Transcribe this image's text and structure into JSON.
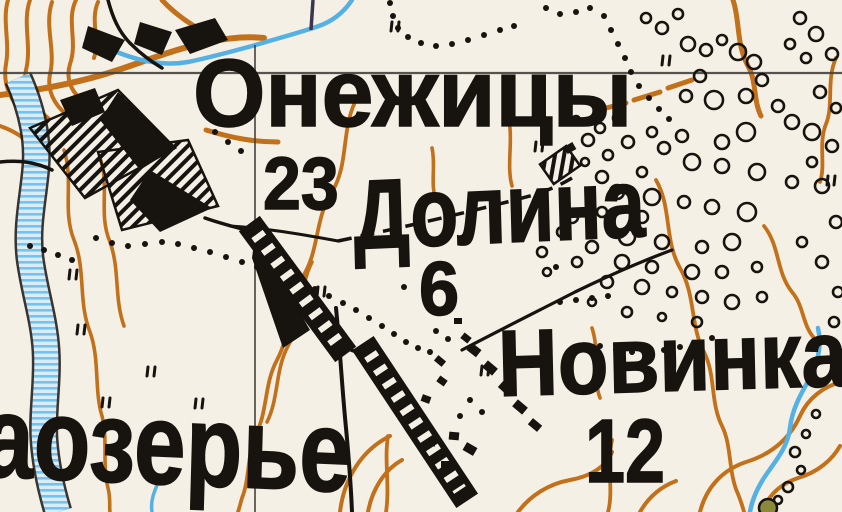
{
  "map": {
    "title": "Soviet topographic map fragment",
    "colors": {
      "paper": "#f5f0e6",
      "contour": "#c2701a",
      "water": "#4fadе4",
      "water_stroke": "#55b0e4",
      "water_light": "#d9edf9",
      "water_mid": "#74c2ee",
      "ink": "#17130f",
      "grid": "#45423e",
      "violet": "#3a3550",
      "olive": "#8a8a3a"
    },
    "labels": [
      {
        "id": "onezhitsy",
        "text": "Онежицы",
        "x": 193,
        "y": 46,
        "size": 96,
        "sx": 0.97,
        "rot": 0
      },
      {
        "id": "elev-23",
        "text": "23",
        "x": 263,
        "y": 147,
        "size": 74,
        "sx": 0.92,
        "rot": 0
      },
      {
        "id": "dolina",
        "text": "Долина",
        "x": 352,
        "y": 166,
        "size": 98,
        "sx": 0.8,
        "rot": -2
      },
      {
        "id": "elev-6",
        "text": "6",
        "x": 419,
        "y": 252,
        "size": 76,
        "sx": 0.95,
        "rot": 0
      },
      {
        "id": "novinka",
        "text": "Новинка",
        "x": 497,
        "y": 317,
        "size": 94,
        "sx": 0.88,
        "rot": -1.5
      },
      {
        "id": "elev-12",
        "text": "12",
        "x": 585,
        "y": 407,
        "size": 90,
        "sx": 0.8,
        "rot": 0
      },
      {
        "id": "aozerye",
        "text": "аозерье",
        "x": -16,
        "y": 378,
        "size": 116,
        "sx": 0.8,
        "rot": 2
      }
    ],
    "grid": {
      "h_lines": [
        {
          "x1": 0,
          "y1": 73,
          "x2": 842,
          "y2": 73
        }
      ],
      "v_lines": [
        {
          "x1": 255,
          "y1": 45,
          "x2": 255,
          "y2": 512
        }
      ],
      "violet_segs": [
        {
          "x1": 313,
          "y1": 0,
          "x2": 311,
          "y2": 30
        }
      ]
    },
    "contours": [
      {
        "d": "M 8,0 C 2,20 10,42 6,64 C 2,86 12,102 24,114",
        "w": 4
      },
      {
        "d": "M 30,0 C 22,22 32,46 26,70 C 22,90 32,106 48,118",
        "w": 4
      },
      {
        "d": "M 52,2 C 44,26 56,50 50,74 C 46,94 58,110 74,120",
        "w": 4
      },
      {
        "d": "M 76,0 C 66,20 78,42 70,64 C 64,84 76,98 92,108",
        "w": 4
      },
      {
        "d": "M 98,2 C 90,20 100,40 94,58",
        "w": 4
      },
      {
        "d": "M 0,126 C 18,132 34,144 42,160",
        "w": 4
      },
      {
        "d": "M 0,95 C 40,90 82,82 118,70 C 148,60 178,48 208,42 C 228,38 246,36 264,38",
        "w": 6
      },
      {
        "d": "M 162,0 C 175,14 192,26 212,36",
        "w": 5
      },
      {
        "d": "M 206,130 C 232,138 254,142 278,142",
        "w": 5
      },
      {
        "d": "M 64,150 C 74,180 62,210 74,240 C 86,270 78,302 90,332 C 100,360 94,390 102,416 C 108,440 102,464 108,488 C 111,500 109,508 110,512",
        "w": 3.6
      },
      {
        "d": "M 100,158 C 110,186 98,214 110,242 C 120,270 114,298 124,326",
        "w": 3.6
      },
      {
        "d": "M 358,96 C 340,128 350,162 332,192 C 314,220 320,250 302,278 C 287,303 292,332 277,360 C 264,384 268,410 256,434 C 247,454 250,478 242,498 C 240,505 239,509 238,512",
        "w": 3.8
      },
      {
        "d": "M 312,262 C 298,290 303,320 288,346 C 275,370 279,398 267,422",
        "w": 3.6
      },
      {
        "d": "M 340,512 C 344,478 362,450 390,436",
        "w": 4
      },
      {
        "d": "M 368,512 C 372,490 384,470 402,460",
        "w": 4
      },
      {
        "d": "M 432,148 C 436,166 430,184 436,200",
        "w": 3.6
      },
      {
        "d": "M 388,436 C 384,460 390,486 386,512",
        "w": 3.8
      },
      {
        "d": "M 612,440 C 606,464 614,490 608,512",
        "w": 3.8
      },
      {
        "d": "M 508,116 C 514,140 506,164 512,186",
        "w": 3.6
      },
      {
        "d": "M 733,0 C 740,20 736,44 748,66 C 757,82 753,100 761,116",
        "w": 5
      },
      {
        "d": "M 598,110 L 626,103",
        "w": 5
      },
      {
        "d": "M 634,100 L 660,92",
        "w": 5
      },
      {
        "d": "M 668,88 L 692,80",
        "w": 5
      },
      {
        "d": "M 656,180 C 672,208 664,240 680,268 C 696,296 690,326 704,352 C 716,376 710,402 722,426 C 732,446 728,472 738,494 C 742,504 743,508 744,512",
        "w": 3.8
      },
      {
        "d": "M 836,58 C 826,80 834,104 826,124 C 818,144 826,164 820,182",
        "w": 3.8
      },
      {
        "d": "M 764,226 C 780,246 776,272 792,292 C 804,306 802,324 814,338",
        "w": 3.8
      },
      {
        "d": "M 700,512 C 706,488 722,470 746,462 C 772,454 790,438 800,416 C 808,398 824,386 842,382",
        "w": 4
      },
      {
        "d": "M 762,512 C 768,496 780,484 798,478 C 818,472 832,460 840,446",
        "w": 4
      },
      {
        "d": "M 518,512 C 530,496 548,484 570,480 C 592,476 606,466 612,452",
        "w": 4
      },
      {
        "d": "M 640,512 C 648,498 660,487 676,481",
        "w": 4
      },
      {
        "d": "M 592,328 C 600,352 592,376 600,398",
        "w": 3.6
      }
    ],
    "river_band": {
      "d": "M 18,78 C 30,105 38,135 36,165 C 34,195 26,225 30,258 C 34,290 44,318 46,350 C 48,382 42,412 44,440 C 46,468 52,492 58,512",
      "outer_w": 29,
      "inner_w": 24
    },
    "streams": [
      {
        "d": "M 352,0 C 344,12 332,22 316,27 C 295,34 272,40 252,46 C 230,52 208,58 188,62 C 165,66 140,62 112,50 C 100,45 92,42 85,44",
        "w": 4.5
      },
      {
        "d": "M 818,328 C 822,345 818,362 810,378 C 800,395 792,410 790,428 C 788,445 778,458 768,472 C 758,486 752,500 750,512",
        "w": 4.5
      },
      {
        "d": "M 160,478 C 155,490 150,500 152,512",
        "w": 3.5
      }
    ],
    "roads_solid": [
      {
        "d": "M 108,0 C 112,15 118,32 132,45 C 142,55 152,62 162,68",
        "w": 3.5
      },
      {
        "d": "M 0,162 C 20,160 35,162 52,170",
        "w": 3.5
      },
      {
        "d": "M 205,218 C 222,224 238,228 254,232",
        "w": 3.5
      },
      {
        "d": "M 230,226 C 265,228 300,234 338,241",
        "w": 3
      },
      {
        "d": "M 338,345 L 372,358",
        "w": 3.5
      },
      {
        "d": "M 336,308 C 340,348 342,388 346,428 C 349,460 351,488 352,512",
        "w": 4
      },
      {
        "d": "M 462,350 C 500,330 540,310 575,292 C 610,275 645,260 672,250",
        "w": 3.2
      }
    ],
    "roads_dashed": [
      {
        "d": "M 338,241 C 400,228 470,212 530,196 C 550,190 562,184 572,178",
        "w": 3.5,
        "dash": "14 9"
      }
    ],
    "strips": [
      {
        "x1": 257,
        "y1": 234,
        "x2": 338,
        "y2": 344
      },
      {
        "x1": 370,
        "y1": 354,
        "x2": 460,
        "y2": 490
      }
    ],
    "settlement_hatched": [
      "M 30,128 L 118,90 L 175,148 L 85,198 Z",
      "M 98,152 L 188,140 L 218,206 L 122,230 Z"
    ],
    "settlement_solid": [
      "M 118,92 L 175,148 L 140,170 L 100,120 Z",
      "M 150,170 L 212,208 L 160,232 L 130,200 Z",
      "M 60,100 L 95,88 L 105,112 L 72,126 Z",
      "M 88,26 L 125,40 L 112,62 L 82,48 Z",
      "M 140,22 L 172,32 L 162,55 L 134,44 Z",
      "M 175,30 L 215,18 L 228,40 L 190,54 Z",
      "M 255,235 L 310,330 L 283,348 L 252,258 Z"
    ],
    "hatched_buildings": [
      {
        "x": 560,
        "y": 165,
        "w": 32,
        "h": 24,
        "rot": -35
      }
    ],
    "buildings": [
      [
        474,
        350,
        12,
        9,
        38
      ],
      [
        490,
        368,
        13,
        9,
        40
      ],
      [
        505,
        388,
        12,
        8,
        42
      ],
      [
        520,
        407,
        13,
        9,
        40
      ],
      [
        535,
        425,
        12,
        8,
        40
      ],
      [
        454,
        436,
        10,
        8,
        5
      ],
      [
        470,
        449,
        12,
        9,
        30
      ],
      [
        446,
        465,
        10,
        8,
        0
      ],
      [
        431,
        443,
        8,
        7,
        0
      ],
      [
        426,
        399,
        9,
        7,
        20
      ],
      [
        442,
        381,
        9,
        7,
        35
      ],
      [
        458,
        321,
        8,
        6,
        0
      ],
      [
        440,
        361,
        10,
        7,
        40
      ],
      [
        466,
        338,
        9,
        7,
        38
      ],
      [
        570,
        148,
        10,
        8,
        -30
      ]
    ],
    "circles": [
      [
        646,
        18,
        5
      ],
      [
        662,
        28,
        6
      ],
      [
        678,
        14,
        5
      ],
      [
        800,
        18,
        6
      ],
      [
        816,
        34,
        7
      ],
      [
        832,
        54,
        6
      ],
      [
        806,
        58,
        5
      ],
      [
        790,
        44,
        5
      ],
      [
        688,
        44,
        7
      ],
      [
        706,
        50,
        6
      ],
      [
        722,
        40,
        5
      ],
      [
        738,
        52,
        8
      ],
      [
        754,
        62,
        7
      ],
      [
        700,
        76,
        6
      ],
      [
        686,
        96,
        6
      ],
      [
        714,
        100,
        9
      ],
      [
        746,
        96,
        7
      ],
      [
        762,
        80,
        6
      ],
      [
        778,
        106,
        6
      ],
      [
        792,
        122,
        7
      ],
      [
        812,
        132,
        8
      ],
      [
        832,
        146,
        6
      ],
      [
        746,
        132,
        9
      ],
      [
        722,
        142,
        7
      ],
      [
        682,
        136,
        6
      ],
      [
        652,
        132,
        5
      ],
      [
        664,
        148,
        6
      ],
      [
        692,
        162,
        8
      ],
      [
        722,
        166,
        7
      ],
      [
        757,
        172,
        8
      ],
      [
        792,
        182,
        6
      ],
      [
        822,
        186,
        7
      ],
      [
        836,
        108,
        5
      ],
      [
        820,
        92,
        6
      ],
      [
        642,
        172,
        5
      ],
      [
        602,
        177,
        6
      ],
      [
        617,
        192,
        7
      ],
      [
        652,
        197,
        8
      ],
      [
        684,
        202,
        6
      ],
      [
        712,
        207,
        7
      ],
      [
        747,
        212,
        9
      ],
      [
        642,
        217,
        6
      ],
      [
        602,
        212,
        5
      ],
      [
        572,
        217,
        6
      ],
      [
        627,
        237,
        8
      ],
      [
        662,
        242,
        7
      ],
      [
        702,
        247,
        6
      ],
      [
        732,
        242,
        8
      ],
      [
        562,
        232,
        5
      ],
      [
        592,
        247,
        6
      ],
      [
        542,
        252,
        5
      ],
      [
        622,
        262,
        7
      ],
      [
        652,
        267,
        6
      ],
      [
        692,
        272,
        7
      ],
      [
        722,
        272,
        6
      ],
      [
        757,
        267,
        5
      ],
      [
        577,
        262,
        5
      ],
      [
        547,
        272,
        4
      ],
      [
        607,
        282,
        6
      ],
      [
        642,
        287,
        7
      ],
      [
        672,
        292,
        5
      ],
      [
        702,
        297,
        6
      ],
      [
        732,
        302,
        7
      ],
      [
        762,
        297,
        5
      ],
      [
        812,
        162,
        5
      ],
      [
        836,
        222,
        6
      ],
      [
        802,
        242,
        5
      ],
      [
        822,
        262,
        6
      ],
      [
        838,
        292,
        5
      ],
      [
        697,
        322,
        5
      ],
      [
        662,
        317,
        4
      ],
      [
        627,
        312,
        5
      ],
      [
        592,
        302,
        4
      ],
      [
        834,
        322,
        5
      ],
      [
        608,
        155,
        5
      ],
      [
        585,
        162,
        4
      ],
      [
        588,
        140,
        6
      ],
      [
        600,
        128,
        5
      ],
      [
        576,
        120,
        4
      ],
      [
        618,
        118,
        5
      ],
      [
        628,
        142,
        6
      ],
      [
        795,
        452,
        5
      ],
      [
        801,
        470,
        4
      ],
      [
        788,
        487,
        5
      ],
      [
        778,
        500,
        4
      ],
      [
        806,
        434,
        4
      ],
      [
        816,
        414,
        4
      ]
    ],
    "olive_circle": {
      "x": 768,
      "y": 508,
      "r": 9
    },
    "dots": [
      [
        390,
        3
      ],
      [
        393,
        16
      ],
      [
        398,
        28
      ],
      [
        408,
        37
      ],
      [
        421,
        43
      ],
      [
        436,
        46
      ],
      [
        452,
        44
      ],
      [
        468,
        40
      ],
      [
        484,
        35
      ],
      [
        500,
        30
      ],
      [
        514,
        26
      ],
      [
        546,
        8
      ],
      [
        560,
        14
      ],
      [
        576,
        12
      ],
      [
        590,
        8
      ],
      [
        604,
        16
      ],
      [
        611,
        30
      ],
      [
        618,
        44
      ],
      [
        625,
        58
      ],
      [
        631,
        72
      ],
      [
        639,
        86
      ],
      [
        649,
        98
      ],
      [
        659,
        109
      ],
      [
        669,
        119
      ],
      [
        96,
        238
      ],
      [
        112,
        243
      ],
      [
        128,
        246
      ],
      [
        145,
        244
      ],
      [
        162,
        242
      ],
      [
        178,
        244
      ],
      [
        194,
        248
      ],
      [
        210,
        252
      ],
      [
        226,
        257
      ],
      [
        242,
        262
      ],
      [
        257,
        267
      ],
      [
        272,
        272
      ],
      [
        287,
        277
      ],
      [
        301,
        283
      ],
      [
        315,
        289
      ],
      [
        329,
        296
      ],
      [
        343,
        303
      ],
      [
        356,
        310
      ],
      [
        369,
        318
      ],
      [
        382,
        326
      ],
      [
        394,
        334
      ],
      [
        406,
        342
      ],
      [
        418,
        348
      ],
      [
        430,
        352
      ],
      [
        30,
        246
      ],
      [
        44,
        250
      ],
      [
        58,
        255
      ],
      [
        72,
        260
      ],
      [
        215,
        132
      ],
      [
        228,
        142
      ],
      [
        241,
        151
      ],
      [
        560,
        302
      ],
      [
        576,
        300
      ],
      [
        592,
        298
      ],
      [
        608,
        296
      ],
      [
        600,
        346
      ],
      [
        616,
        350
      ],
      [
        632,
        352
      ],
      [
        648,
        352
      ],
      [
        664,
        350
      ],
      [
        680,
        347
      ],
      [
        696,
        343
      ],
      [
        712,
        338
      ],
      [
        404,
        287
      ],
      [
        436,
        331
      ],
      [
        448,
        339
      ],
      [
        556,
        267
      ],
      [
        470,
        400
      ],
      [
        482,
        412
      ],
      [
        460,
        416
      ]
    ],
    "tufts": [
      [
        78,
        325
      ],
      [
        148,
        367
      ],
      [
        196,
        399
      ],
      [
        318,
        287
      ],
      [
        482,
        366
      ],
      [
        392,
        22
      ],
      [
        663,
        56
      ],
      [
        103,
        398
      ],
      [
        828,
        176
      ],
      [
        536,
        142
      ],
      [
        70,
        270
      ]
    ]
  }
}
